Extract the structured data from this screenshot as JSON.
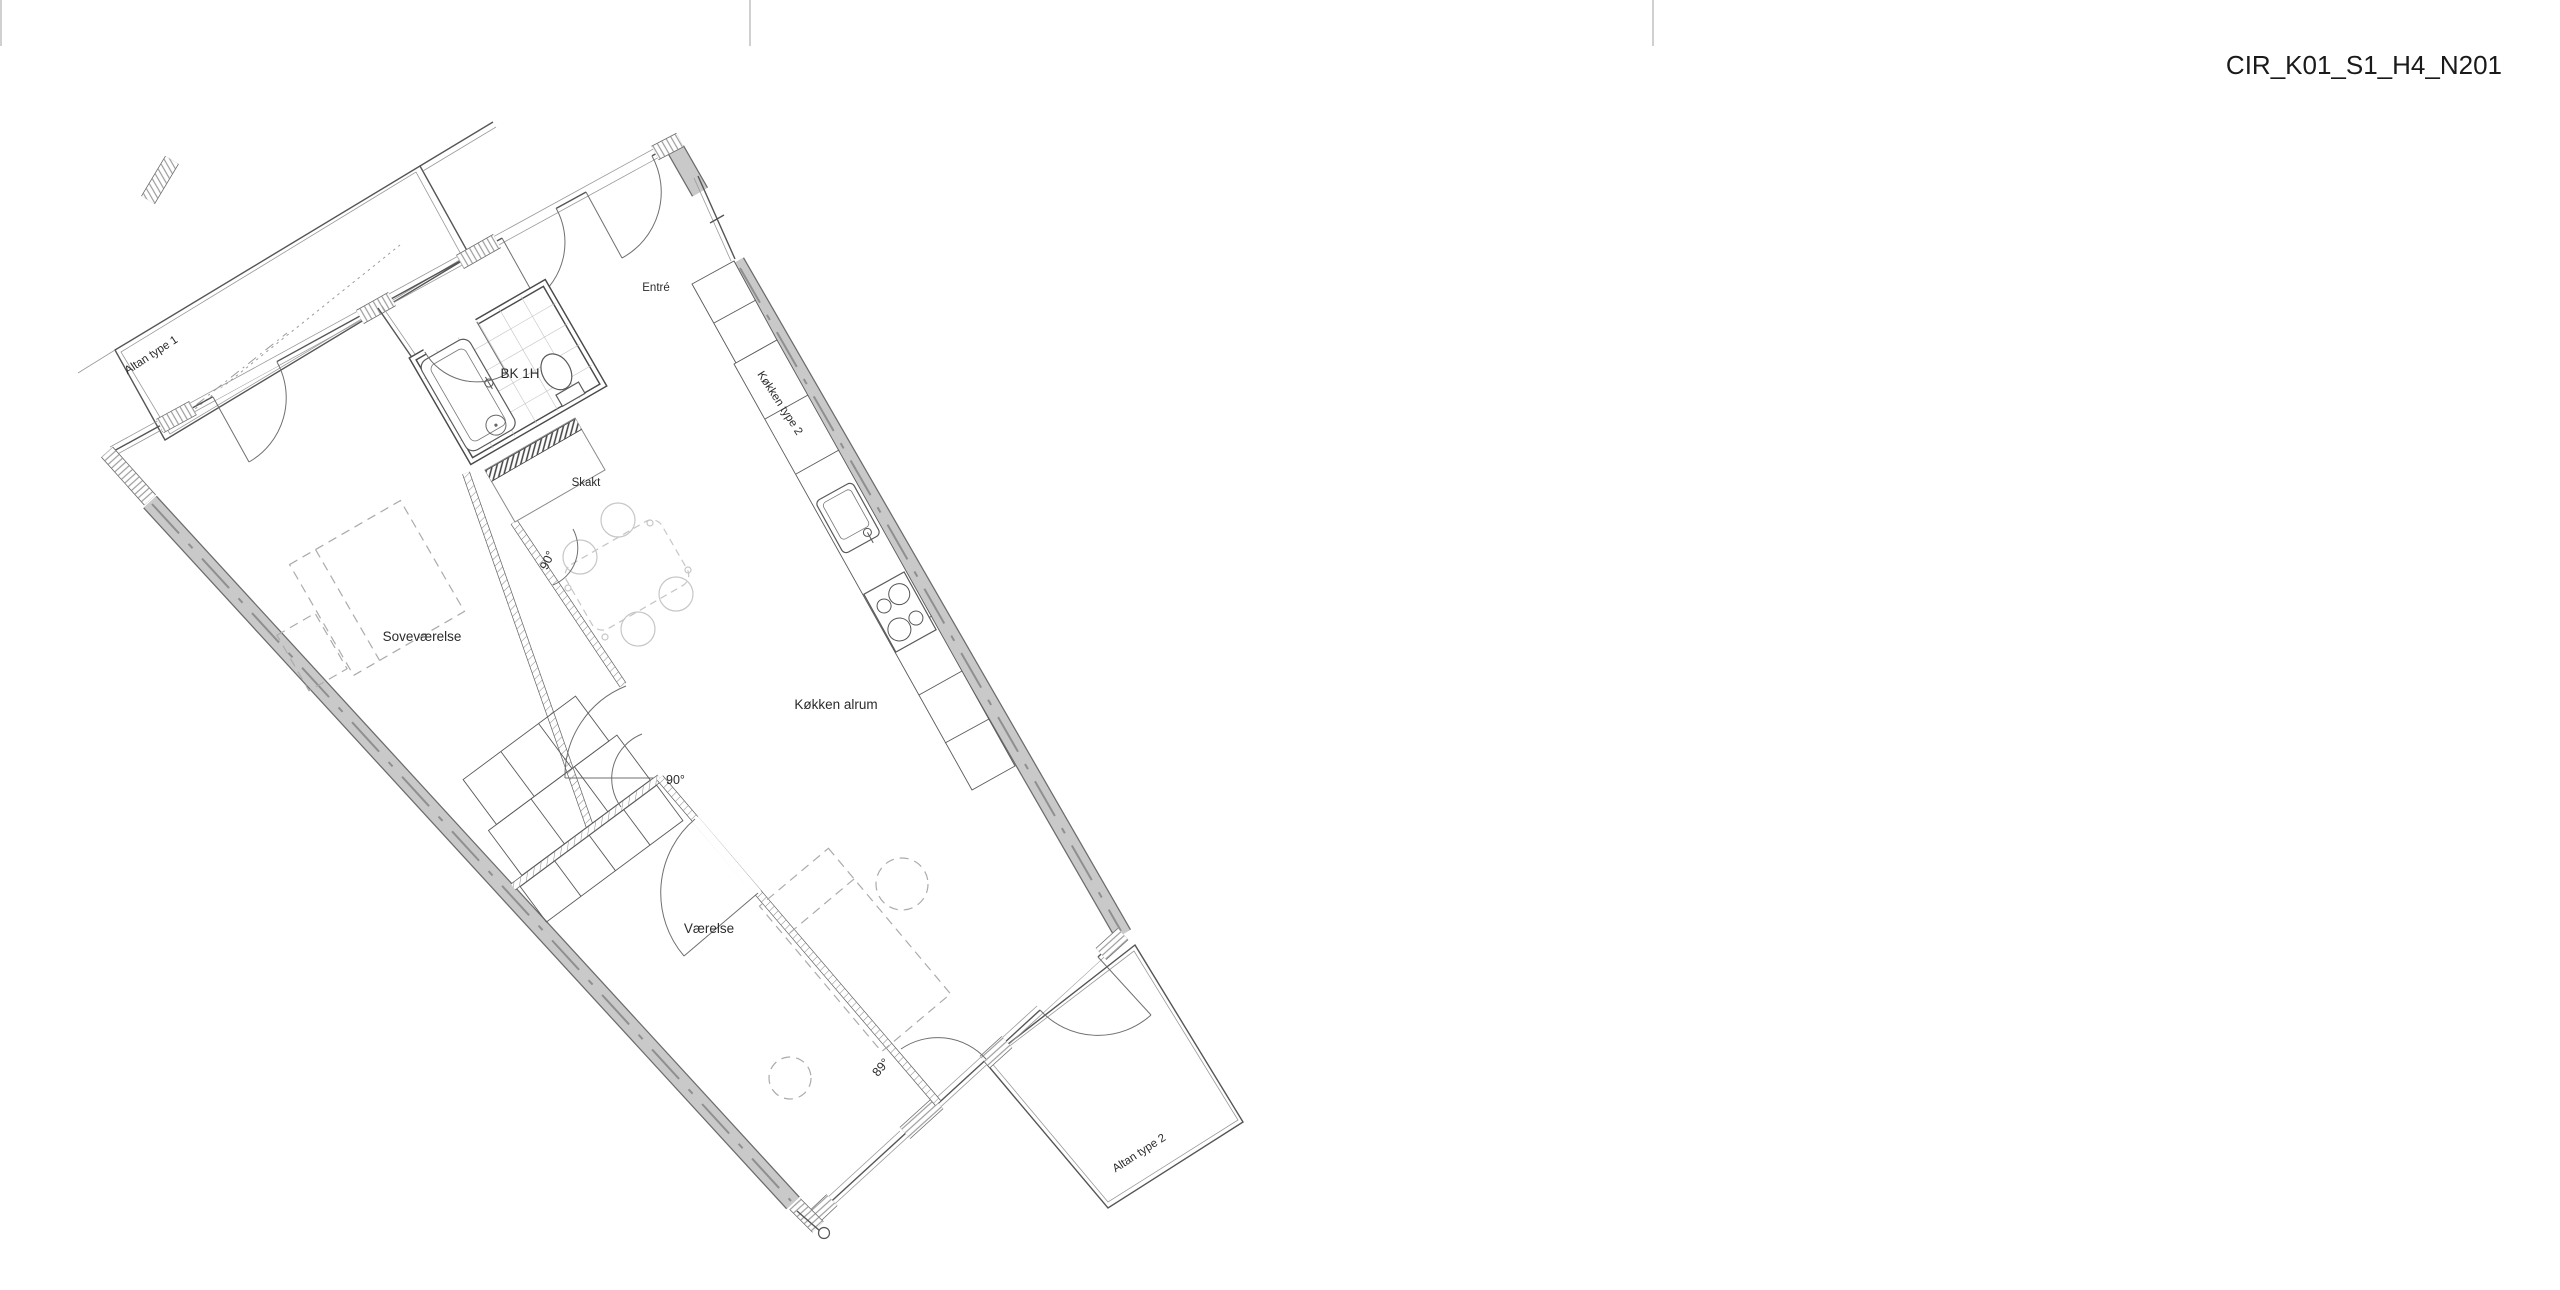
{
  "page": {
    "title": "CIR_K01_S1_H4_N201",
    "background": "#ffffff"
  },
  "plan": {
    "rooms": {
      "altan1": "Altan type 1",
      "entre": "Entré",
      "bk1h": "BK 1H",
      "skakt": "Skakt",
      "kokken_type2": "Køkken type 2",
      "sovevaerelse": "Soveværelse",
      "kokken_alrum": "Køkken alrum",
      "vaerelse": "Værelse",
      "altan2": "Altan type 2"
    },
    "angles": {
      "a1": "90°",
      "a2": "90°",
      "a3": "89°"
    }
  },
  "colors": {
    "wall_gray": "#c9c9c9",
    "wall_edge": "#6b6b6b",
    "line_dark": "#555555",
    "hatch": "#8f8f8f",
    "furniture_light": "#c6c6c6",
    "text": "#2b2b2b"
  }
}
